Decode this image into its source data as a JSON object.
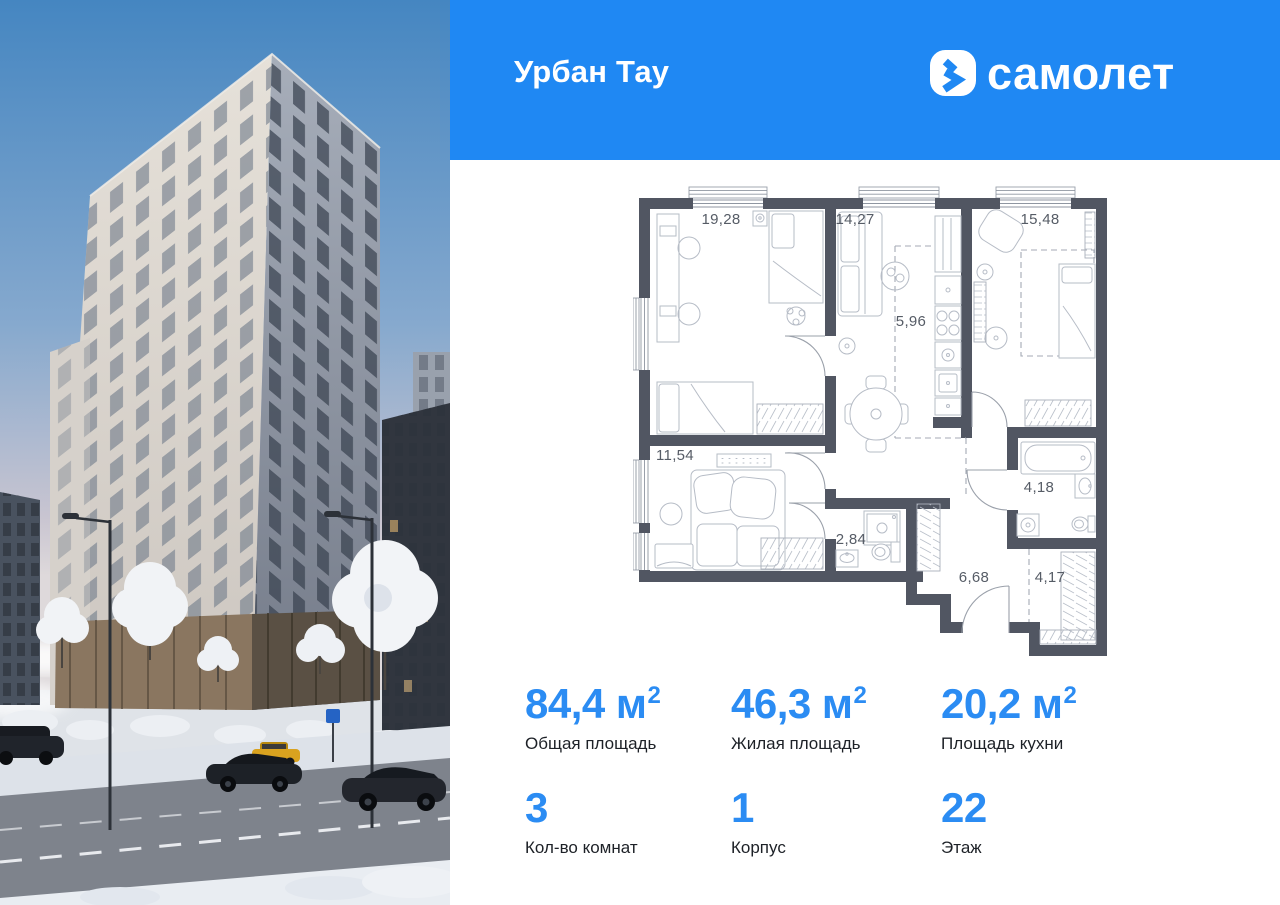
{
  "colors": {
    "header_bg": "#1f88f3",
    "accent": "#2b8cf3",
    "wall": "#515662"
  },
  "header": {
    "project_name": "Урбан Тау",
    "brand_name": "самолет"
  },
  "floor_plan": {
    "rooms": [
      {
        "key": "bedroom-1",
        "area": "19,28"
      },
      {
        "key": "living-room",
        "area": "14,27"
      },
      {
        "key": "bedroom-2",
        "area": "15,48"
      },
      {
        "key": "kitchen-zone",
        "area": "5,96"
      },
      {
        "key": "bedroom-3",
        "area": "11,54"
      },
      {
        "key": "shower-room",
        "area": "2,84"
      },
      {
        "key": "bathroom",
        "area": "4,18"
      },
      {
        "key": "hallway",
        "area": "6,68"
      },
      {
        "key": "wardrobe-corridor",
        "area": "4,17"
      }
    ]
  },
  "stats": {
    "items": [
      {
        "value": "84,4 м",
        "sup": "2",
        "label": "Общая площадь"
      },
      {
        "value": "46,3 м",
        "sup": "2",
        "label": "Жилая площадь"
      },
      {
        "value": "20,2 м",
        "sup": "2",
        "label": "Площадь кухни"
      },
      {
        "value": "3",
        "sup": "",
        "label": "Кол-во комнат"
      },
      {
        "value": "1",
        "sup": "",
        "label": "Корпус"
      },
      {
        "value": "22",
        "sup": "",
        "label": "Этаж"
      }
    ]
  }
}
